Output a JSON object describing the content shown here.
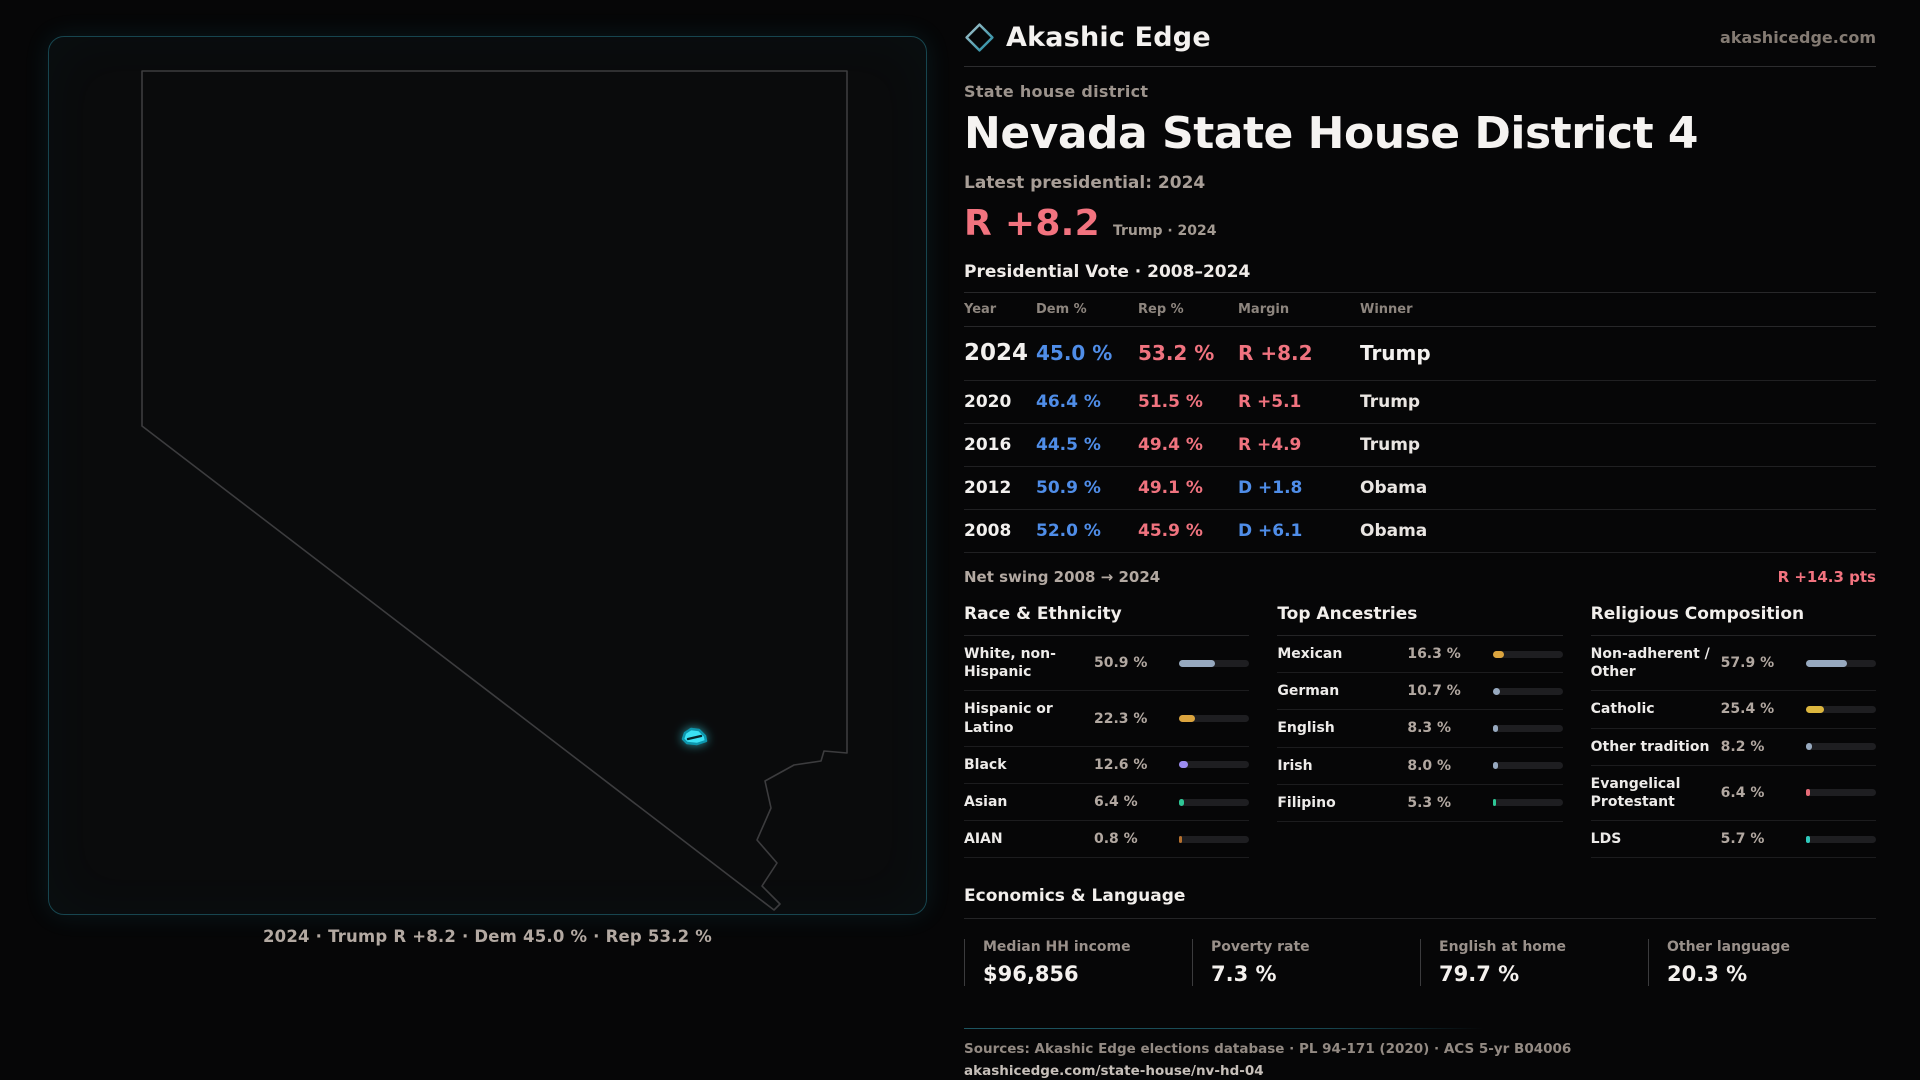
{
  "brand": {
    "name": "Akashic Edge",
    "site_label": "akashicedge.com"
  },
  "page": {
    "kicker": "State house district",
    "title": "Nevada State House District 4",
    "latest_label": "Latest presidential: 2024",
    "headline_margin": "R +8.2",
    "headline_context": "Trump · 2024"
  },
  "map": {
    "caption": "2024 · Trump R +8.2 · Dem 45.0 % · Rep 53.2 %"
  },
  "vote_table": {
    "title": "Presidential Vote · 2008–2024",
    "columns": [
      "Year",
      "Dem %",
      "Rep %",
      "Margin",
      "Winner"
    ],
    "rows": [
      {
        "year": "2024",
        "dem": "45.0 %",
        "rep": "53.2 %",
        "margin": "R +8.2",
        "margin_party": "R",
        "winner": "Trump",
        "emphasis": true
      },
      {
        "year": "2020",
        "dem": "46.4 %",
        "rep": "51.5 %",
        "margin": "R +5.1",
        "margin_party": "R",
        "winner": "Trump",
        "emphasis": false
      },
      {
        "year": "2016",
        "dem": "44.5 %",
        "rep": "49.4 %",
        "margin": "R +4.9",
        "margin_party": "R",
        "winner": "Trump",
        "emphasis": false
      },
      {
        "year": "2012",
        "dem": "50.9 %",
        "rep": "49.1 %",
        "margin": "D +1.8",
        "margin_party": "D",
        "winner": "Obama",
        "emphasis": false
      },
      {
        "year": "2008",
        "dem": "52.0 %",
        "rep": "45.9 %",
        "margin": "D +6.1",
        "margin_party": "D",
        "winner": "Obama",
        "emphasis": false
      }
    ]
  },
  "net_swing": {
    "label": "Net swing 2008 → 2024",
    "value": "R +14.3 pts"
  },
  "colors": {
    "dem": "#4f8de8",
    "rep": "#f0737f",
    "steel": "#97a9bf",
    "amber": "#dba43e",
    "purple": "#9d8df2",
    "green": "#2ec695",
    "rust": "#b5702e",
    "gold": "#dcb63e",
    "pink": "#e56b77",
    "teal": "#2fc9bd",
    "district": "#3be1f4",
    "frame": "#17454f",
    "outline": "#3c3c3e"
  },
  "demographics": [
    {
      "title": "Race & Ethnicity",
      "rows": [
        {
          "label": "White, non-Hispanic",
          "value": "50.9 %",
          "pct": 50.9,
          "color": "steel"
        },
        {
          "label": "Hispanic or Latino",
          "value": "22.3 %",
          "pct": 22.3,
          "color": "amber"
        },
        {
          "label": "Black",
          "value": "12.6 %",
          "pct": 12.6,
          "color": "purple"
        },
        {
          "label": "Asian",
          "value": "6.4 %",
          "pct": 6.4,
          "color": "green"
        },
        {
          "label": "AIAN",
          "value": "0.8 %",
          "pct": 0.8,
          "color": "rust"
        }
      ]
    },
    {
      "title": "Top Ancestries",
      "rows": [
        {
          "label": "Mexican",
          "value": "16.3 %",
          "pct": 16.3,
          "color": "amber"
        },
        {
          "label": "German",
          "value": "10.7 %",
          "pct": 10.7,
          "color": "steel"
        },
        {
          "label": "English",
          "value": "8.3 %",
          "pct": 8.3,
          "color": "steel"
        },
        {
          "label": "Irish",
          "value": "8.0 %",
          "pct": 8.0,
          "color": "steel"
        },
        {
          "label": "Filipino",
          "value": "5.3 %",
          "pct": 5.3,
          "color": "green"
        }
      ]
    },
    {
      "title": "Religious Composition",
      "rows": [
        {
          "label": "Non-adherent / Other",
          "value": "57.9 %",
          "pct": 57.9,
          "color": "steel"
        },
        {
          "label": "Catholic",
          "value": "25.4 %",
          "pct": 25.4,
          "color": "gold"
        },
        {
          "label": "Other tradition",
          "value": "8.2 %",
          "pct": 8.2,
          "color": "steel"
        },
        {
          "label": "Evangelical Protestant",
          "value": "6.4 %",
          "pct": 6.4,
          "color": "pink"
        },
        {
          "label": "LDS",
          "value": "5.7 %",
          "pct": 5.7,
          "color": "teal"
        }
      ]
    }
  ],
  "economics": {
    "title": "Economics & Language",
    "stats": [
      {
        "label": "Median HH income",
        "value": "$96,856"
      },
      {
        "label": "Poverty rate",
        "value": "7.3 %"
      },
      {
        "label": "English at home",
        "value": "79.7 %"
      },
      {
        "label": "Other language",
        "value": "20.3 %"
      }
    ]
  },
  "footer": {
    "sources": "Sources: Akashic Edge elections database · PL 94-171 (2020) · ACS 5-yr B04006",
    "permalink": "akashicedge.com/state-house/nv-hd-04"
  }
}
